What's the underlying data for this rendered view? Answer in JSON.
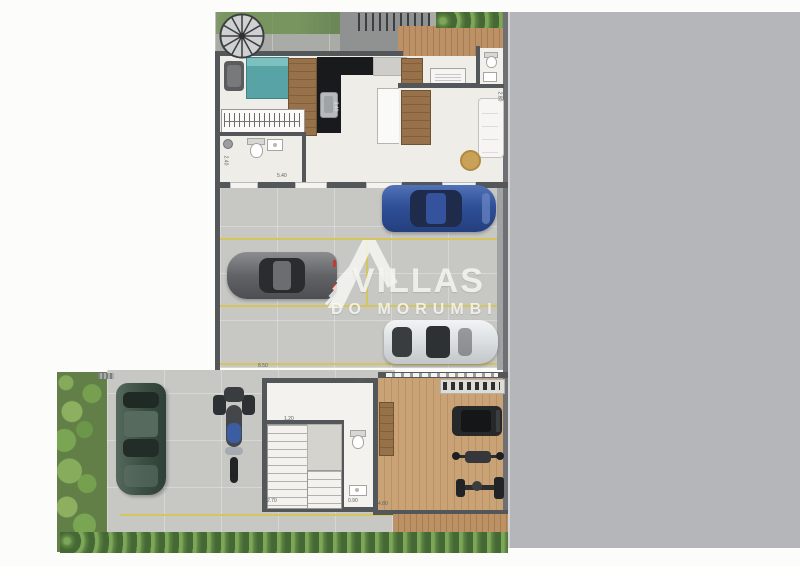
{
  "watermark": {
    "brand_line1": "VILLAS",
    "brand_line2": "DO MORUMBI"
  },
  "dimensions": [
    {
      "label": "2.80",
      "x": 320,
      "y": 52,
      "rot": 0,
      "light": false
    },
    {
      "label": "2.50",
      "x": 350,
      "y": 52,
      "rot": 0,
      "light": false
    },
    {
      "label": "3.40",
      "x": 330,
      "y": 104,
      "rot": 90,
      "light": true
    },
    {
      "label": "2.40",
      "x": 220,
      "y": 158,
      "rot": 90,
      "light": false
    },
    {
      "label": "5.40",
      "x": 277,
      "y": 174,
      "rot": 0,
      "light": false
    },
    {
      "label": "2.80",
      "x": 494,
      "y": 94,
      "rot": 90,
      "light": false
    },
    {
      "label": "8.50",
      "x": 258,
      "y": 364,
      "rot": 0,
      "light": false
    },
    {
      "label": "3.50",
      "x": 355,
      "y": 380,
      "rot": 0,
      "light": false
    },
    {
      "label": "1.20",
      "x": 284,
      "y": 417,
      "rot": 0,
      "light": false
    },
    {
      "label": "2.70",
      "x": 267,
      "y": 499,
      "rot": 0,
      "light": false
    },
    {
      "label": "0.90",
      "x": 348,
      "y": 499,
      "rot": 0,
      "light": false
    },
    {
      "label": "4.80",
      "x": 378,
      "y": 502,
      "rot": 0,
      "light": false
    }
  ],
  "colors": {
    "wall": "#54575a",
    "interior_floor": "#efede8",
    "parking_floor": "#c7c8c4",
    "vacant_lot": "#b4b6b9",
    "wood_deck": "#b08a60",
    "garden": "#617f46",
    "hedge": "#4c6f3a",
    "bed_teal": "#57a3a6",
    "kitchen_black": "#191a1c",
    "yellow_line": "#d6c45c",
    "car_blue": "#3b5fae",
    "car_gray": "#797b7e",
    "car_white": "#e6e8ea",
    "car_green": "#44584d",
    "motorcycle_blue": "#3c5da2",
    "watermark": "#fafaf7"
  }
}
